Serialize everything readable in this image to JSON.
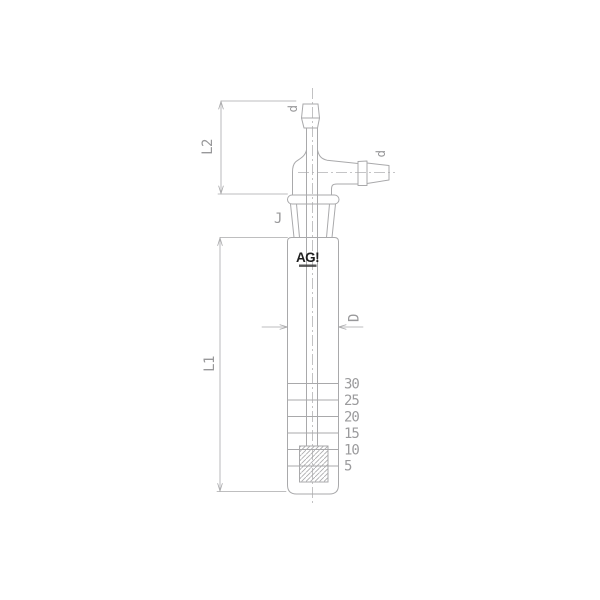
{
  "drawing": {
    "logo": {
      "text": "AG!"
    },
    "dimension_labels": {
      "top_port": "d",
      "side_port": "d",
      "joint": "J",
      "neck_length": "L2",
      "body_length": "L1",
      "body_diameter": "D"
    },
    "graduations": [
      "30",
      "25",
      "20",
      "15",
      "10",
      "5"
    ],
    "colors": {
      "background": "#ffffff",
      "line": "#a9a9ab",
      "label": "#98989a",
      "logo": "#1f1f1f"
    }
  }
}
